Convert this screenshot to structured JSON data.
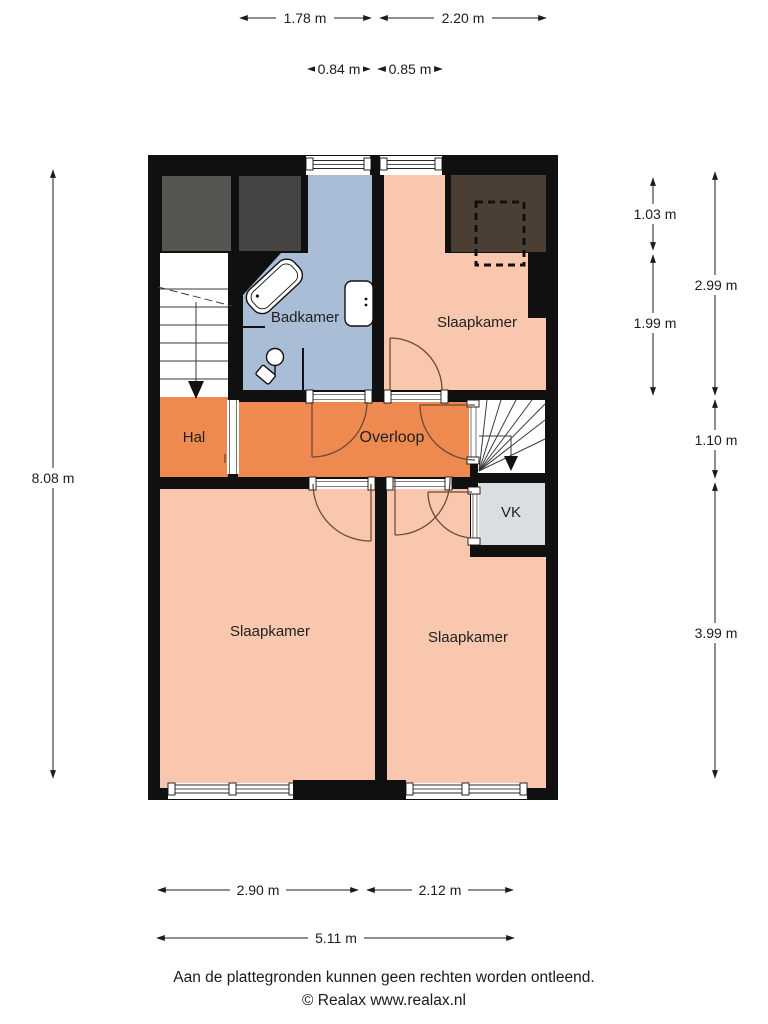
{
  "floorplan": {
    "rooms": {
      "badkamer": {
        "label": "Badkamer"
      },
      "slaapkamer_top": {
        "label": "Slaapkamer"
      },
      "hal": {
        "label": "Hal"
      },
      "overloop": {
        "label": "Overloop"
      },
      "vk": {
        "label": "VK"
      },
      "slaapkamer_left": {
        "label": "Slaapkamer"
      },
      "slaapkamer_right": {
        "label": "Slaapkamer"
      }
    },
    "dimensions": {
      "top_row": [
        {
          "label": "1.78 m"
        },
        {
          "label": "2.20 m"
        }
      ],
      "top_inner_row": [
        {
          "label": "0.84 m"
        },
        {
          "label": "0.85 m"
        }
      ],
      "left": {
        "label": "8.08 m"
      },
      "right_inner": [
        {
          "label": "1.03 m"
        },
        {
          "label": "1.99 m"
        }
      ],
      "right_outer": [
        {
          "label": "2.99 m"
        },
        {
          "label": "1.10 m"
        },
        {
          "label": "3.99 m"
        }
      ],
      "bottom_row": [
        {
          "label": "2.90 m"
        },
        {
          "label": "2.12 m"
        }
      ],
      "bottom_total": {
        "label": "5.11 m"
      }
    },
    "colors": {
      "wall": "#101010",
      "bedroom": "#f8c7ae",
      "hallway": "#ee8a50",
      "bathroom": "#a9bdd6",
      "closet": "#dbdee0",
      "stairs": "#ffffff",
      "attic_dark": "#4b3e35",
      "attic_gray_1": "#575551",
      "attic_gray_2": "#454443",
      "door_swing": "#6f4a38"
    }
  },
  "footer": {
    "disclaimer": "Aan de plattegronden kunnen geen rechten worden ontleend.",
    "credit": "© Realax www.realax.nl"
  }
}
